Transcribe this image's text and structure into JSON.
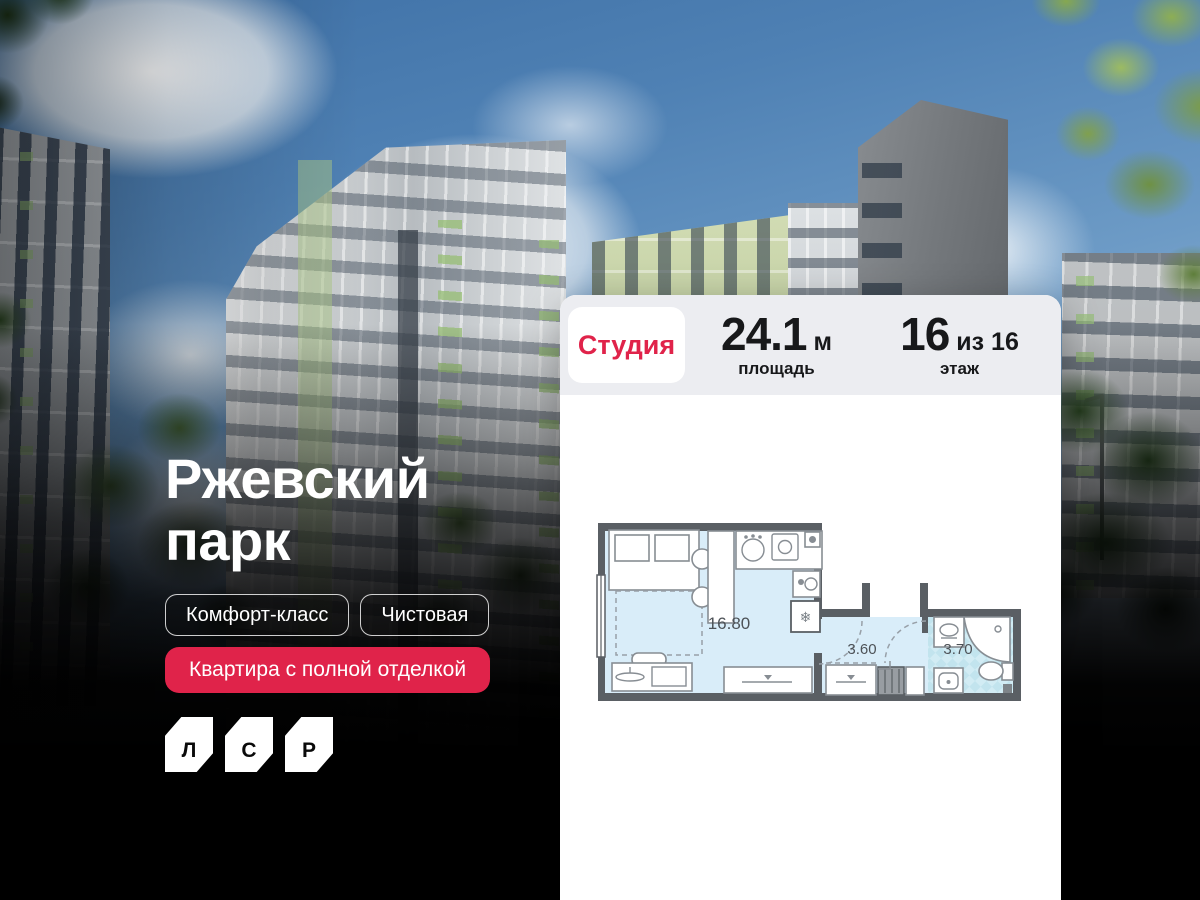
{
  "title": {
    "line1": "Ржевский",
    "line2": "парк"
  },
  "tags": [
    "Комфорт-класс",
    "Чистовая"
  ],
  "cta": {
    "label": "Квартира с полной отделкой"
  },
  "logo": {
    "letters": [
      "Л",
      "С",
      "Р"
    ]
  },
  "card": {
    "type_badge": "Студия",
    "area": {
      "value": "24.1",
      "unit": "м",
      "caption": "площадь"
    },
    "floor": {
      "value": "16",
      "of": "из 16",
      "caption": "этаж"
    },
    "plan": {
      "room_area": "16.80",
      "hall_area": "3.60",
      "bath_area": "3.70",
      "fridge_icon": "❄"
    }
  },
  "colors": {
    "accent": "#e0234a",
    "card_header_bg": "#ecedf1",
    "plan_wall": "#5a5f64",
    "plan_floor": "#d9edf9",
    "plan_bath": "#c2e4ee"
  }
}
